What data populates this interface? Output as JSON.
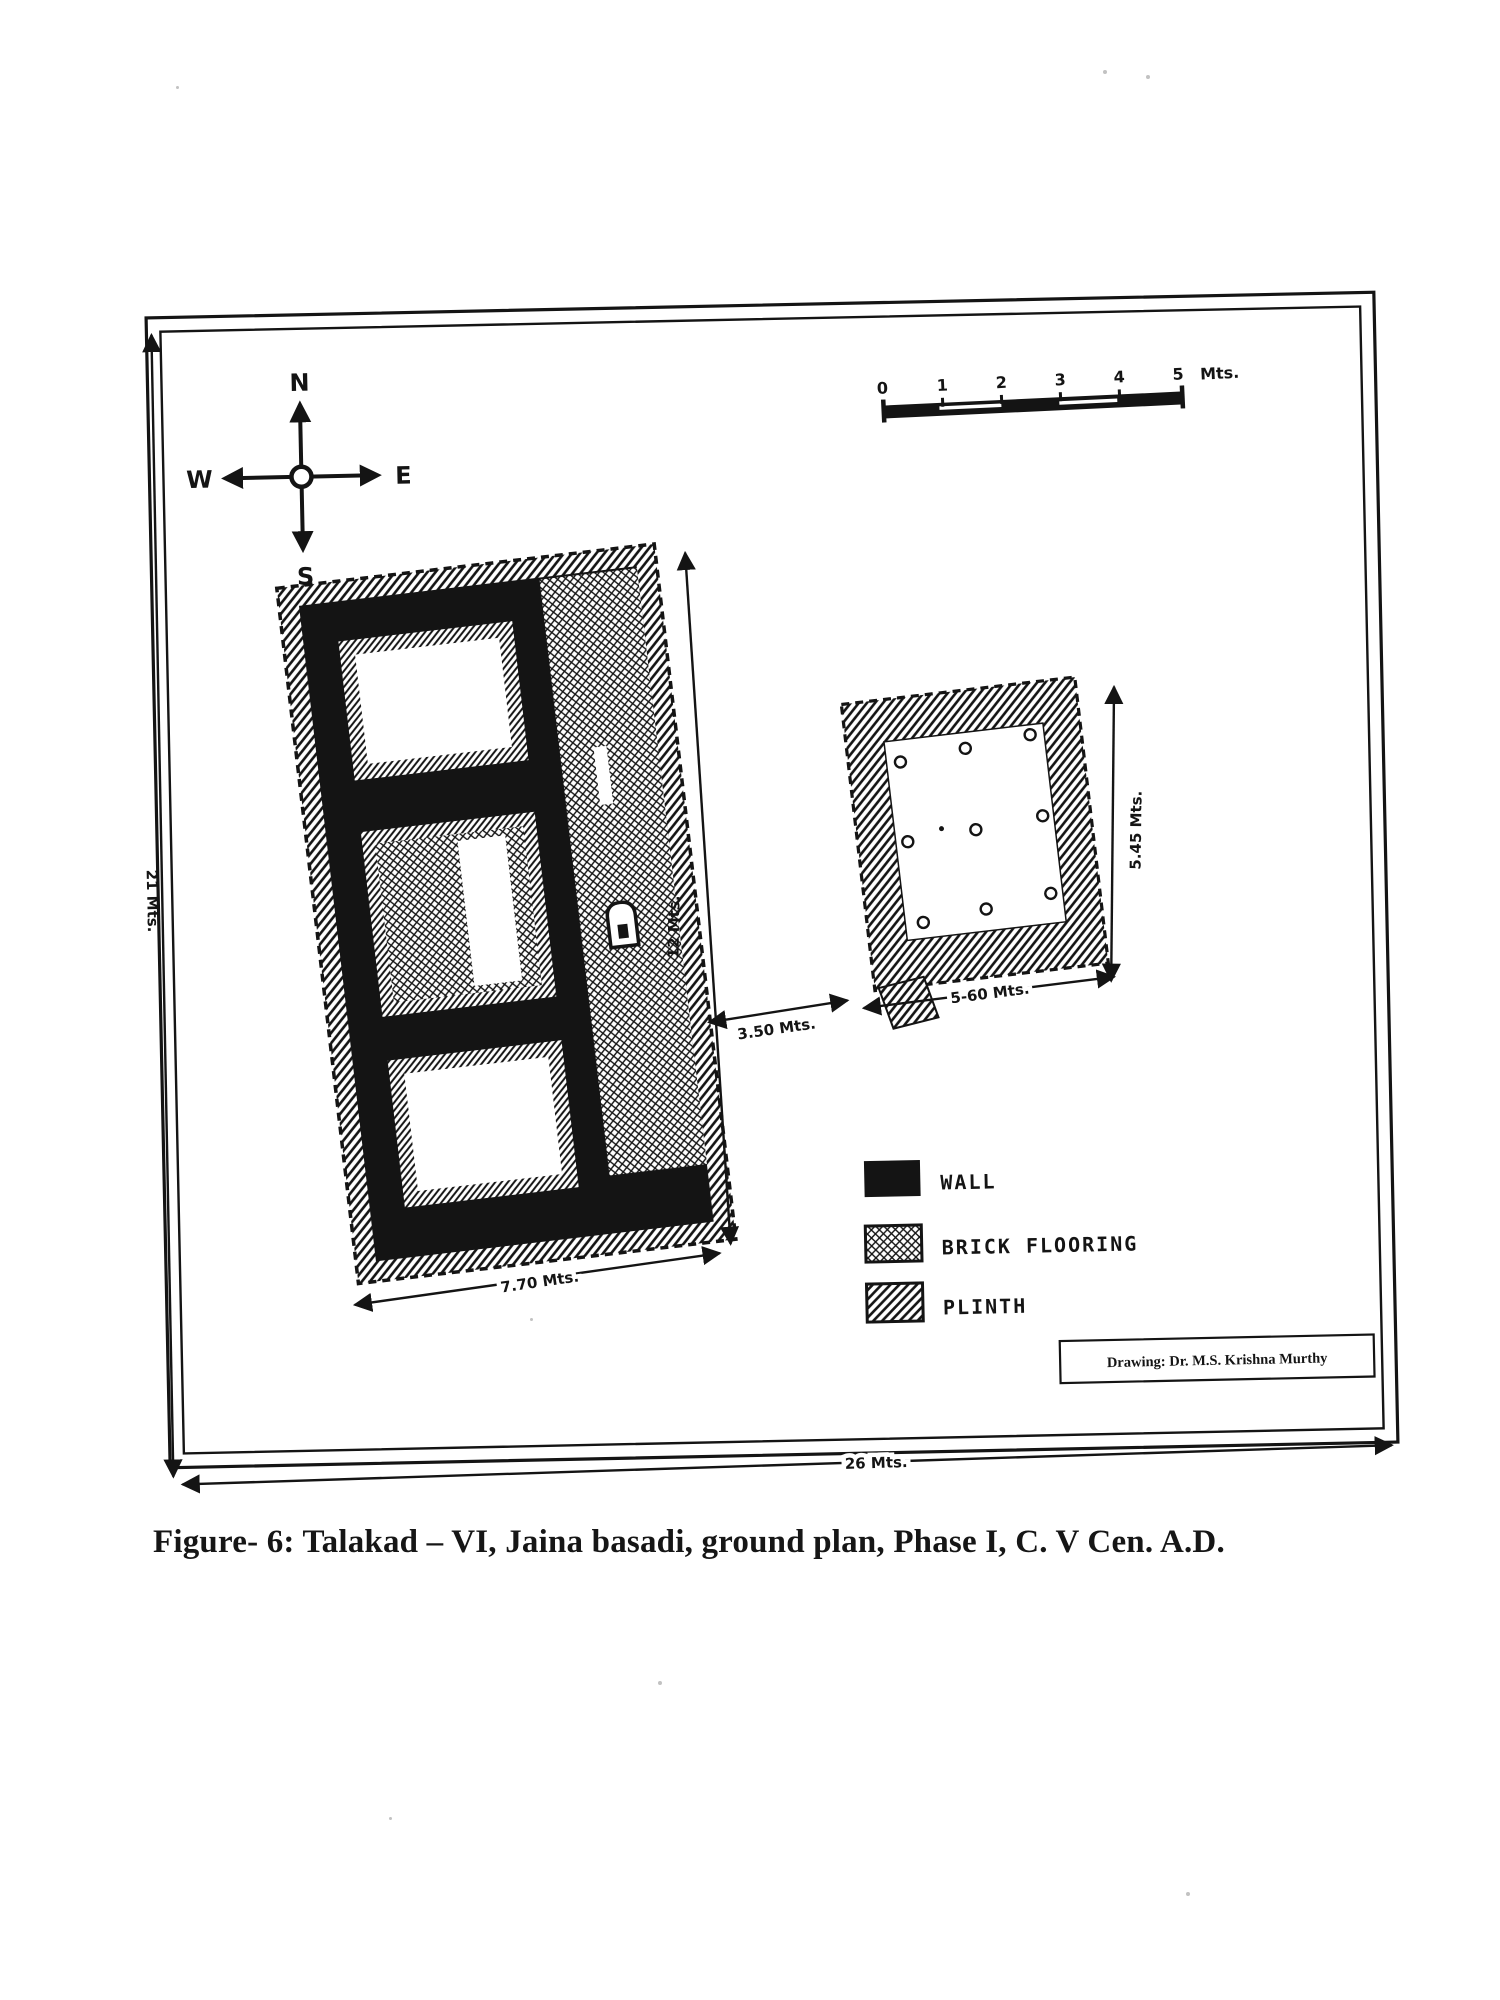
{
  "page": {
    "caption": "Figure- 6: Talakad – VI, Jaina basadi, ground plan, Phase I, C. V Cen. A.D."
  },
  "drawing": {
    "credit": "Drawing: Dr. M.S. Krishna Murthy",
    "compass": {
      "n": "N",
      "e": "E",
      "s": "S",
      "w": "W"
    },
    "scale_bar": {
      "ticks": [
        "0",
        "1",
        "2",
        "3",
        "4",
        "5"
      ],
      "unit": "Mts."
    },
    "dimensions": {
      "enclosure_height": "21 Mts.",
      "enclosure_width": "26 Mts.",
      "basadi_width": "7.70 Mts.",
      "basadi_length": "12 Mts.",
      "gap": "3.50 Mts.",
      "mandapa_width": "5-60 Mts.",
      "mandapa_depth": "5.45 Mts."
    },
    "legend": {
      "items": [
        {
          "label": "WALL",
          "pattern": "solid"
        },
        {
          "label": "BRICK FLOORING",
          "pattern": "crosshatch"
        },
        {
          "label": "PLINTH",
          "pattern": "diagonal-hatch"
        }
      ]
    }
  },
  "colors": {
    "ink": "#141414",
    "paper": "#ffffff"
  }
}
